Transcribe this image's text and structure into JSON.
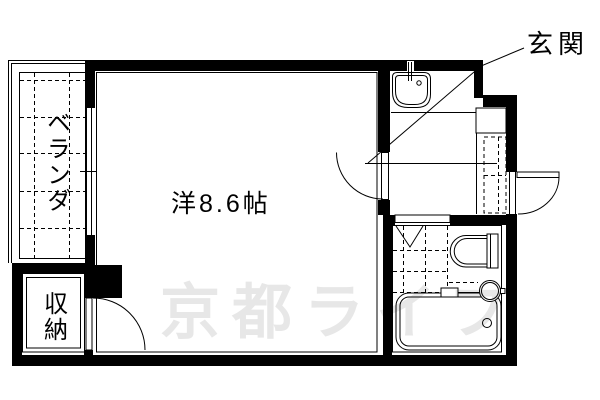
{
  "floorplan": {
    "labels": {
      "entrance": "玄関",
      "room": "洋8.6帖",
      "balcony": "ベランダ",
      "storage": "収納"
    },
    "watermark": "京都ライフ",
    "colors": {
      "line": "#000000",
      "background": "#ffffff",
      "watermark": "#e7e7e7"
    }
  }
}
